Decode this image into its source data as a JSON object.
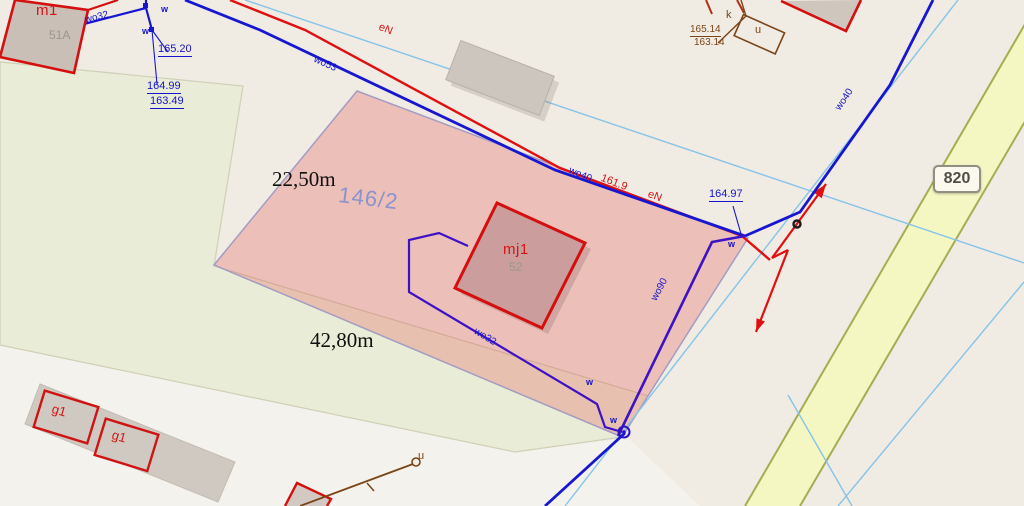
{
  "map": {
    "parcel": {
      "number": "146/2",
      "top_width": "22,50m",
      "bottom_width": "42,80m"
    },
    "road": {
      "number": "820"
    },
    "buildings": {
      "m1": {
        "code": "m1",
        "address": "51A"
      },
      "mj1": {
        "code": "mj1",
        "address": "52"
      },
      "g1_left": {
        "code": "g1"
      },
      "g1_right": {
        "code": "g1"
      }
    },
    "elevations": {
      "nw_upper": "165.20",
      "nw_top": "164.99",
      "nw_bottom": "163.49",
      "east_top": "164.97",
      "ne_top": "165.14",
      "ne_bottom": "163.14"
    },
    "utilities": {
      "water_service_nw": "wo32",
      "water_main_w": "wo53",
      "water_main_mid": "wo40",
      "water_main_ne": "wo40",
      "water_main_s": "wo90",
      "water_service_s": "wo32",
      "water_mark_1": "w",
      "water_mark_2": "w",
      "water_mark_3": "w",
      "water_mark_4": "w",
      "water_mark_5": "w",
      "power_w": "eN",
      "power_e": "eN",
      "power_value": "161.9",
      "sewer_k": "k",
      "utility_u_ne": "u",
      "utility_u_s": "u"
    },
    "palette": {
      "background": "#f0ebe3",
      "field_green": "#e9ecd6",
      "parcel_pink": "#e14b4b",
      "road_fill": "#f5f7c3",
      "road_edge": "#a3ad52",
      "water_main": "#1717cf",
      "water_service": "#3d12c4",
      "power_line": "#e01010",
      "sewer_line": "#7a4518",
      "building_fill": "#cdc5bc",
      "building_outline": "#d40f0f",
      "survey_blue": "#86c4e9",
      "parcel_label": "#8b93cc"
    }
  }
}
